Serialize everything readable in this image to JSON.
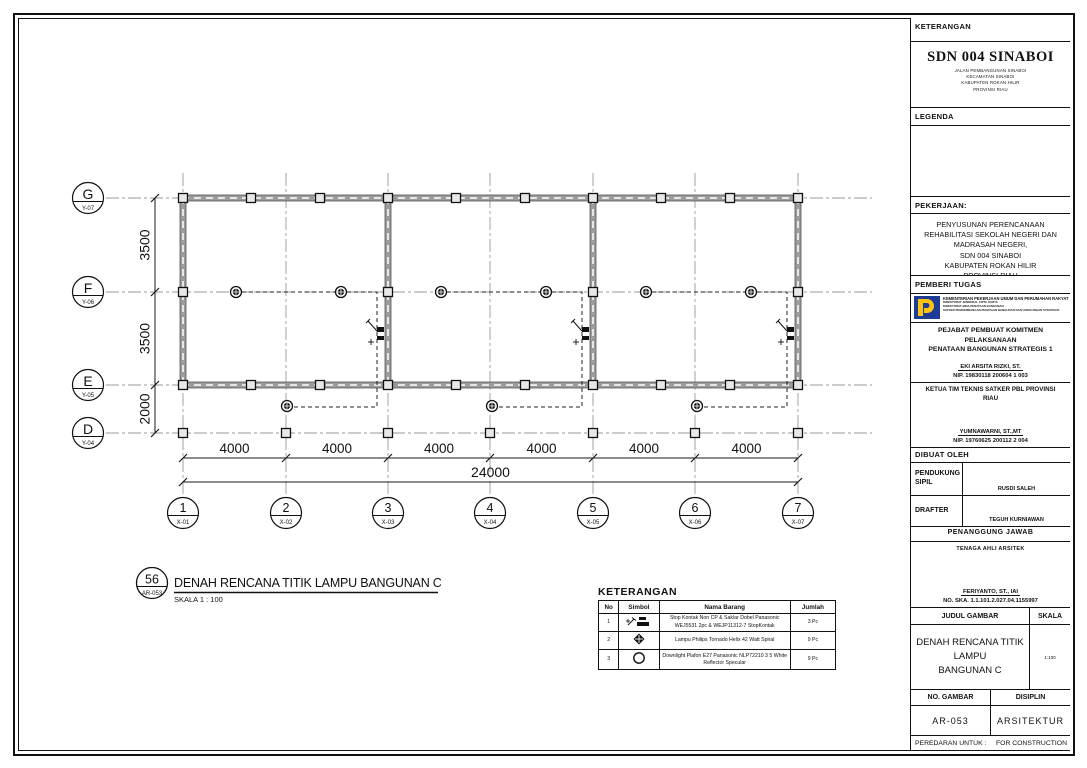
{
  "colors": {
    "ink": "#111111",
    "wall_grey": "#9c9c9c",
    "grid_grey": "#9a9aa0",
    "logo_blue": "#1d3c96",
    "logo_yellow": "#ffc20e"
  },
  "titleblock": {
    "keterangan_label": "KETERANGAN",
    "project": {
      "name": "SDN 004 SINABOI",
      "address": "JALAN PEMBANGUNAN SINABOI\nKECAMATAN SINABOI\nKABUPATEN ROKAN HILIR\nPROVINSI RIAU"
    },
    "legenda_label": "LEGENDA",
    "pekerjaan_label": "PEKERJAAN:",
    "pekerjaan_text": "PENYUSUNAN PERENCANAAN\nREHABILITASI SEKOLAH NEGERI DAN\nMADRASAH NEGERI,\nSDN 004 SINABOI\nKABUPATEN  ROKAN HILIR\nPROVINSI RIAU",
    "pemberi_tugas_label": "PEMBERI  TUGAS",
    "kementerian_line1": "KEMENTERIAN PEKERJAAN UMUM DAN PERUMAHAN RAKYAT",
    "kementerian_lines": "DIREKTORAT JENDERAL CIPTA KARYA\nDIREKTORAT BINA PENATAAN BANGUNAN\nSATKER PENGEMBANGAN PENATAAN BANGUNAN DAN LINGKUNGAN STRATEGIS",
    "ppk_title": "PEJABAT  PEMBUAT  KOMITMEN  PELAKSANAAN\nPENATAAN  BANGUNAN  STRATEGIS  1",
    "sig_ppk": {
      "name": "EKI  ARSITA  RIZKI,  ST.",
      "nip": "NIP. 19830118  200604  1  003"
    },
    "ketua_title": "KETUA  TIM  TEKNIS  SATKER  PBL  PROVINSI\nRIAU",
    "sig_ketua": {
      "name": "YUMNAWARNI,  ST.,MT",
      "nip": "NIP. 19760625  200112  2  004"
    },
    "dibuat_oleh_label": "DIBUAT  OLEH",
    "made_by_rows": [
      {
        "role": "PENDUKUNG\nSIPIL",
        "name": "RUSDI  SALEH"
      },
      {
        "role": "DRAFTER",
        "name": "TEGUH  KURNIAWAN"
      }
    ],
    "penanggung_jawab_label": "PENANGGUNG  JAWAB",
    "tenaga_ahli_label": "TENAGA  AHLI  ARSITEK",
    "sig_arsitek": {
      "name": "FERIYANTO,  ST.,  IAI",
      "ska": "NO. SKA. 1.1.101.2.027.04.1155997"
    },
    "judul_gambar_label": "JUDUL  GAMBAR",
    "skala_label": "SKALA",
    "judul_gambar": "DENAH RENCANA TITIK LAMPU\nBANGUNAN C",
    "skala_value": "1:100",
    "no_gambar_label": "NO.  GAMBAR",
    "disiplin_label": "DISIPLIN",
    "no_gambar": "AR-053",
    "disiplin": "ARSITEKTUR",
    "peredaran_label": "PEREDARAN UNTUK :",
    "peredaran_value": "FOR CONSTRUCTION"
  },
  "plan": {
    "title_number": "56",
    "title_code": "AR-053",
    "title": "DENAH RENCANA TITIK LAMPU BANGUNAN C",
    "scale_label": "SKALA    1 : 100",
    "col_bubbles": [
      {
        "num": "1",
        "code": "X-01"
      },
      {
        "num": "2",
        "code": "X-02"
      },
      {
        "num": "3",
        "code": "X-03"
      },
      {
        "num": "4",
        "code": "X-04"
      },
      {
        "num": "5",
        "code": "X-05"
      },
      {
        "num": "6",
        "code": "X-06"
      },
      {
        "num": "7",
        "code": "X-07"
      }
    ],
    "row_bubbles": [
      {
        "num": "G",
        "code": "Y-07"
      },
      {
        "num": "F",
        "code": "Y-06"
      },
      {
        "num": "E",
        "code": "Y-05"
      },
      {
        "num": "D",
        "code": "Y-04"
      }
    ],
    "dims_vertical": [
      "3500",
      "3500",
      "2000"
    ],
    "dims_horizontal": [
      "4000",
      "4000",
      "4000",
      "4000",
      "4000",
      "4000"
    ],
    "dim_total": "24000"
  },
  "legend": {
    "title": "KETERANGAN",
    "headers": [
      "No",
      "Simbol",
      "Nama Barang",
      "Jumlah"
    ],
    "rows": [
      {
        "no": "1",
        "symbol": "stop-kontak-saklar",
        "name": "Stop Kontak Non CP & Saklar Dobel Panasonic WEJ5531 2pc & WEJP11312-7 StopKontak",
        "qty": "3 Pc"
      },
      {
        "no": "2",
        "symbol": "lampu-tornado",
        "name": "Lampu Philips Tornado Helix 42 Watt Spiral",
        "qty": "9 Pc"
      },
      {
        "no": "3",
        "symbol": "downlight",
        "name": "Downlight Plafon E27 Panasonic NLP72210 3 5 White Reflector Specular",
        "qty": "9 Pc"
      }
    ]
  }
}
